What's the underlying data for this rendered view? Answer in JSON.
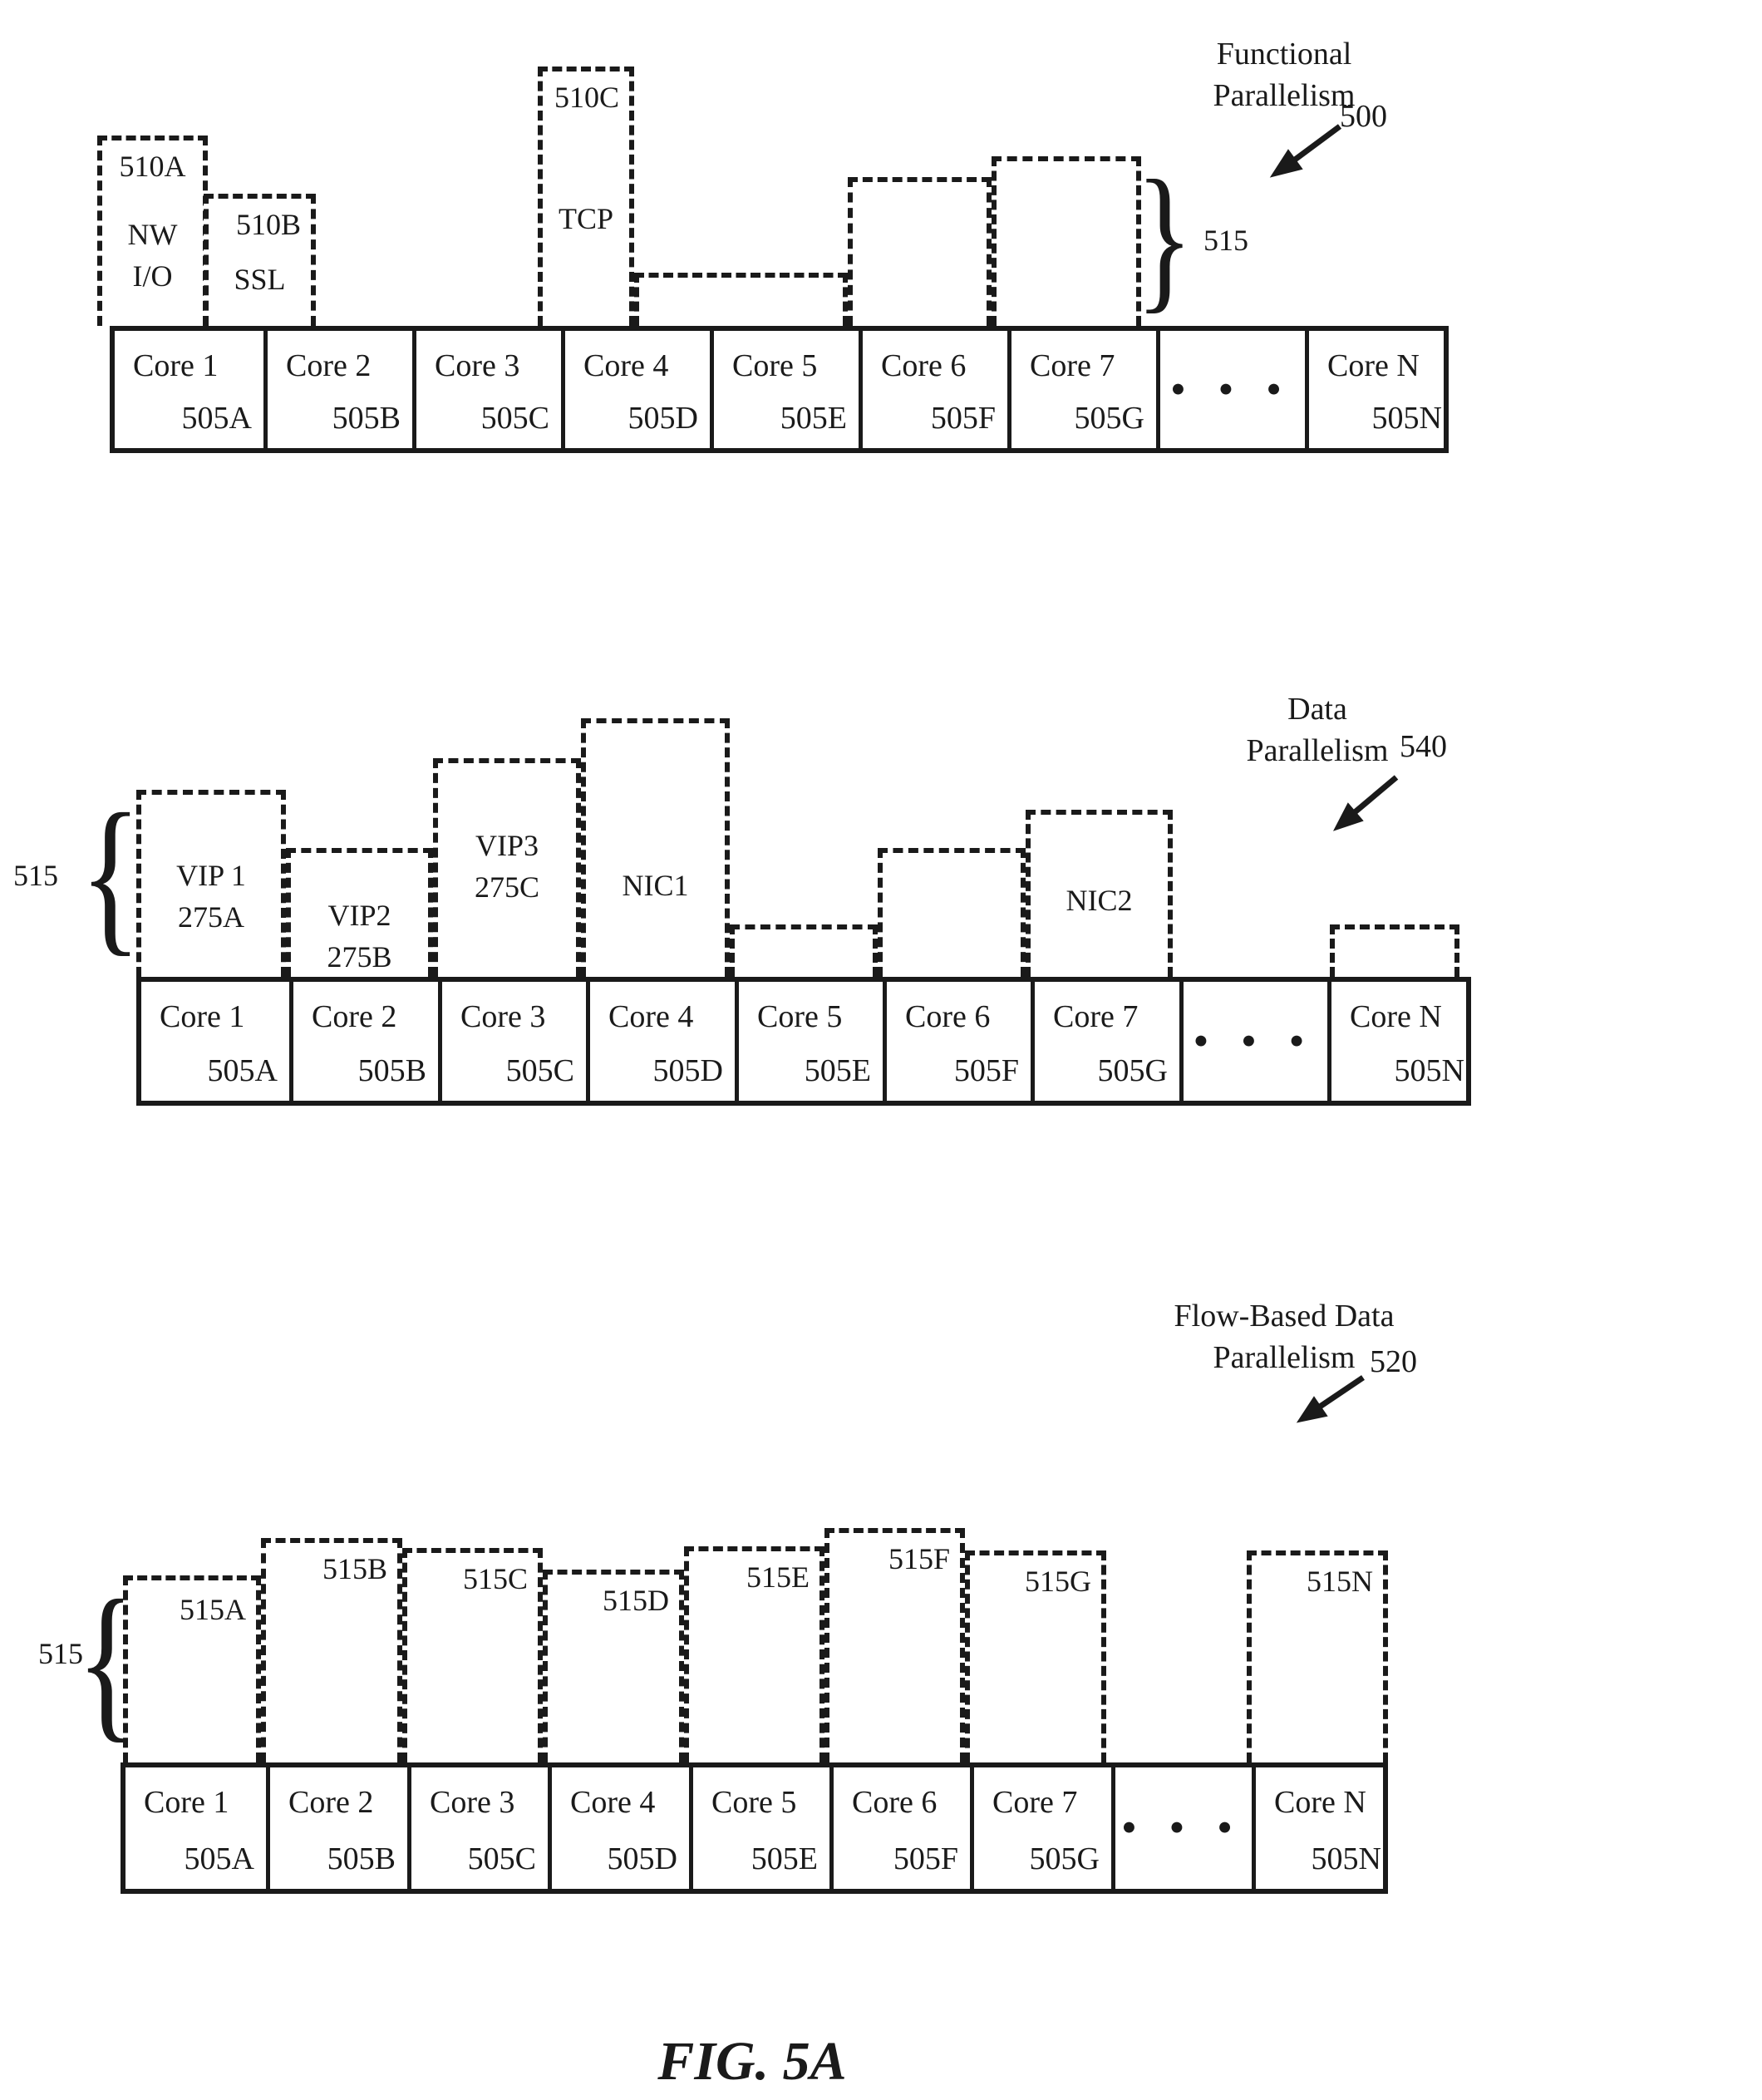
{
  "caption": "FIG. 5A",
  "ellipsis_dots": "● ● ●",
  "cores": [
    {
      "name": "Core 1",
      "id": "505A"
    },
    {
      "name": "Core 2",
      "id": "505B"
    },
    {
      "name": "Core 3",
      "id": "505C"
    },
    {
      "name": "Core 4",
      "id": "505D"
    },
    {
      "name": "Core 5",
      "id": "505E"
    },
    {
      "name": "Core 6",
      "id": "505F"
    },
    {
      "name": "Core 7",
      "id": "505G"
    },
    {
      "name": "Core N",
      "id": "505N"
    }
  ],
  "functional": {
    "title1": "Functional",
    "title2": "Parallelism",
    "ref": "500",
    "brace_label": "515",
    "box_510a": {
      "label": "510A",
      "line1": "NW",
      "line2": "I/O"
    },
    "box_510b": {
      "label": "510B",
      "line1": "SSL"
    },
    "box_510c": {
      "label": "510C",
      "line1": "TCP"
    }
  },
  "data_par": {
    "title1": "Data",
    "title2": "Parallelism",
    "ref": "540",
    "brace_label": "515",
    "vip1_line1": "VIP 1",
    "vip1_line2": "275A",
    "vip2_line1": "VIP2",
    "vip2_line2": "275B",
    "vip3_line1": "VIP3",
    "vip3_line2": "275C",
    "nic1": "NIC1",
    "nic2": "NIC2"
  },
  "flow_par": {
    "title1": "Flow-Based Data",
    "title2": "Parallelism",
    "ref": "520",
    "brace_label": "515",
    "labels": [
      "515A",
      "515B",
      "515C",
      "515D",
      "515E",
      "515F",
      "515G",
      "515N"
    ]
  }
}
